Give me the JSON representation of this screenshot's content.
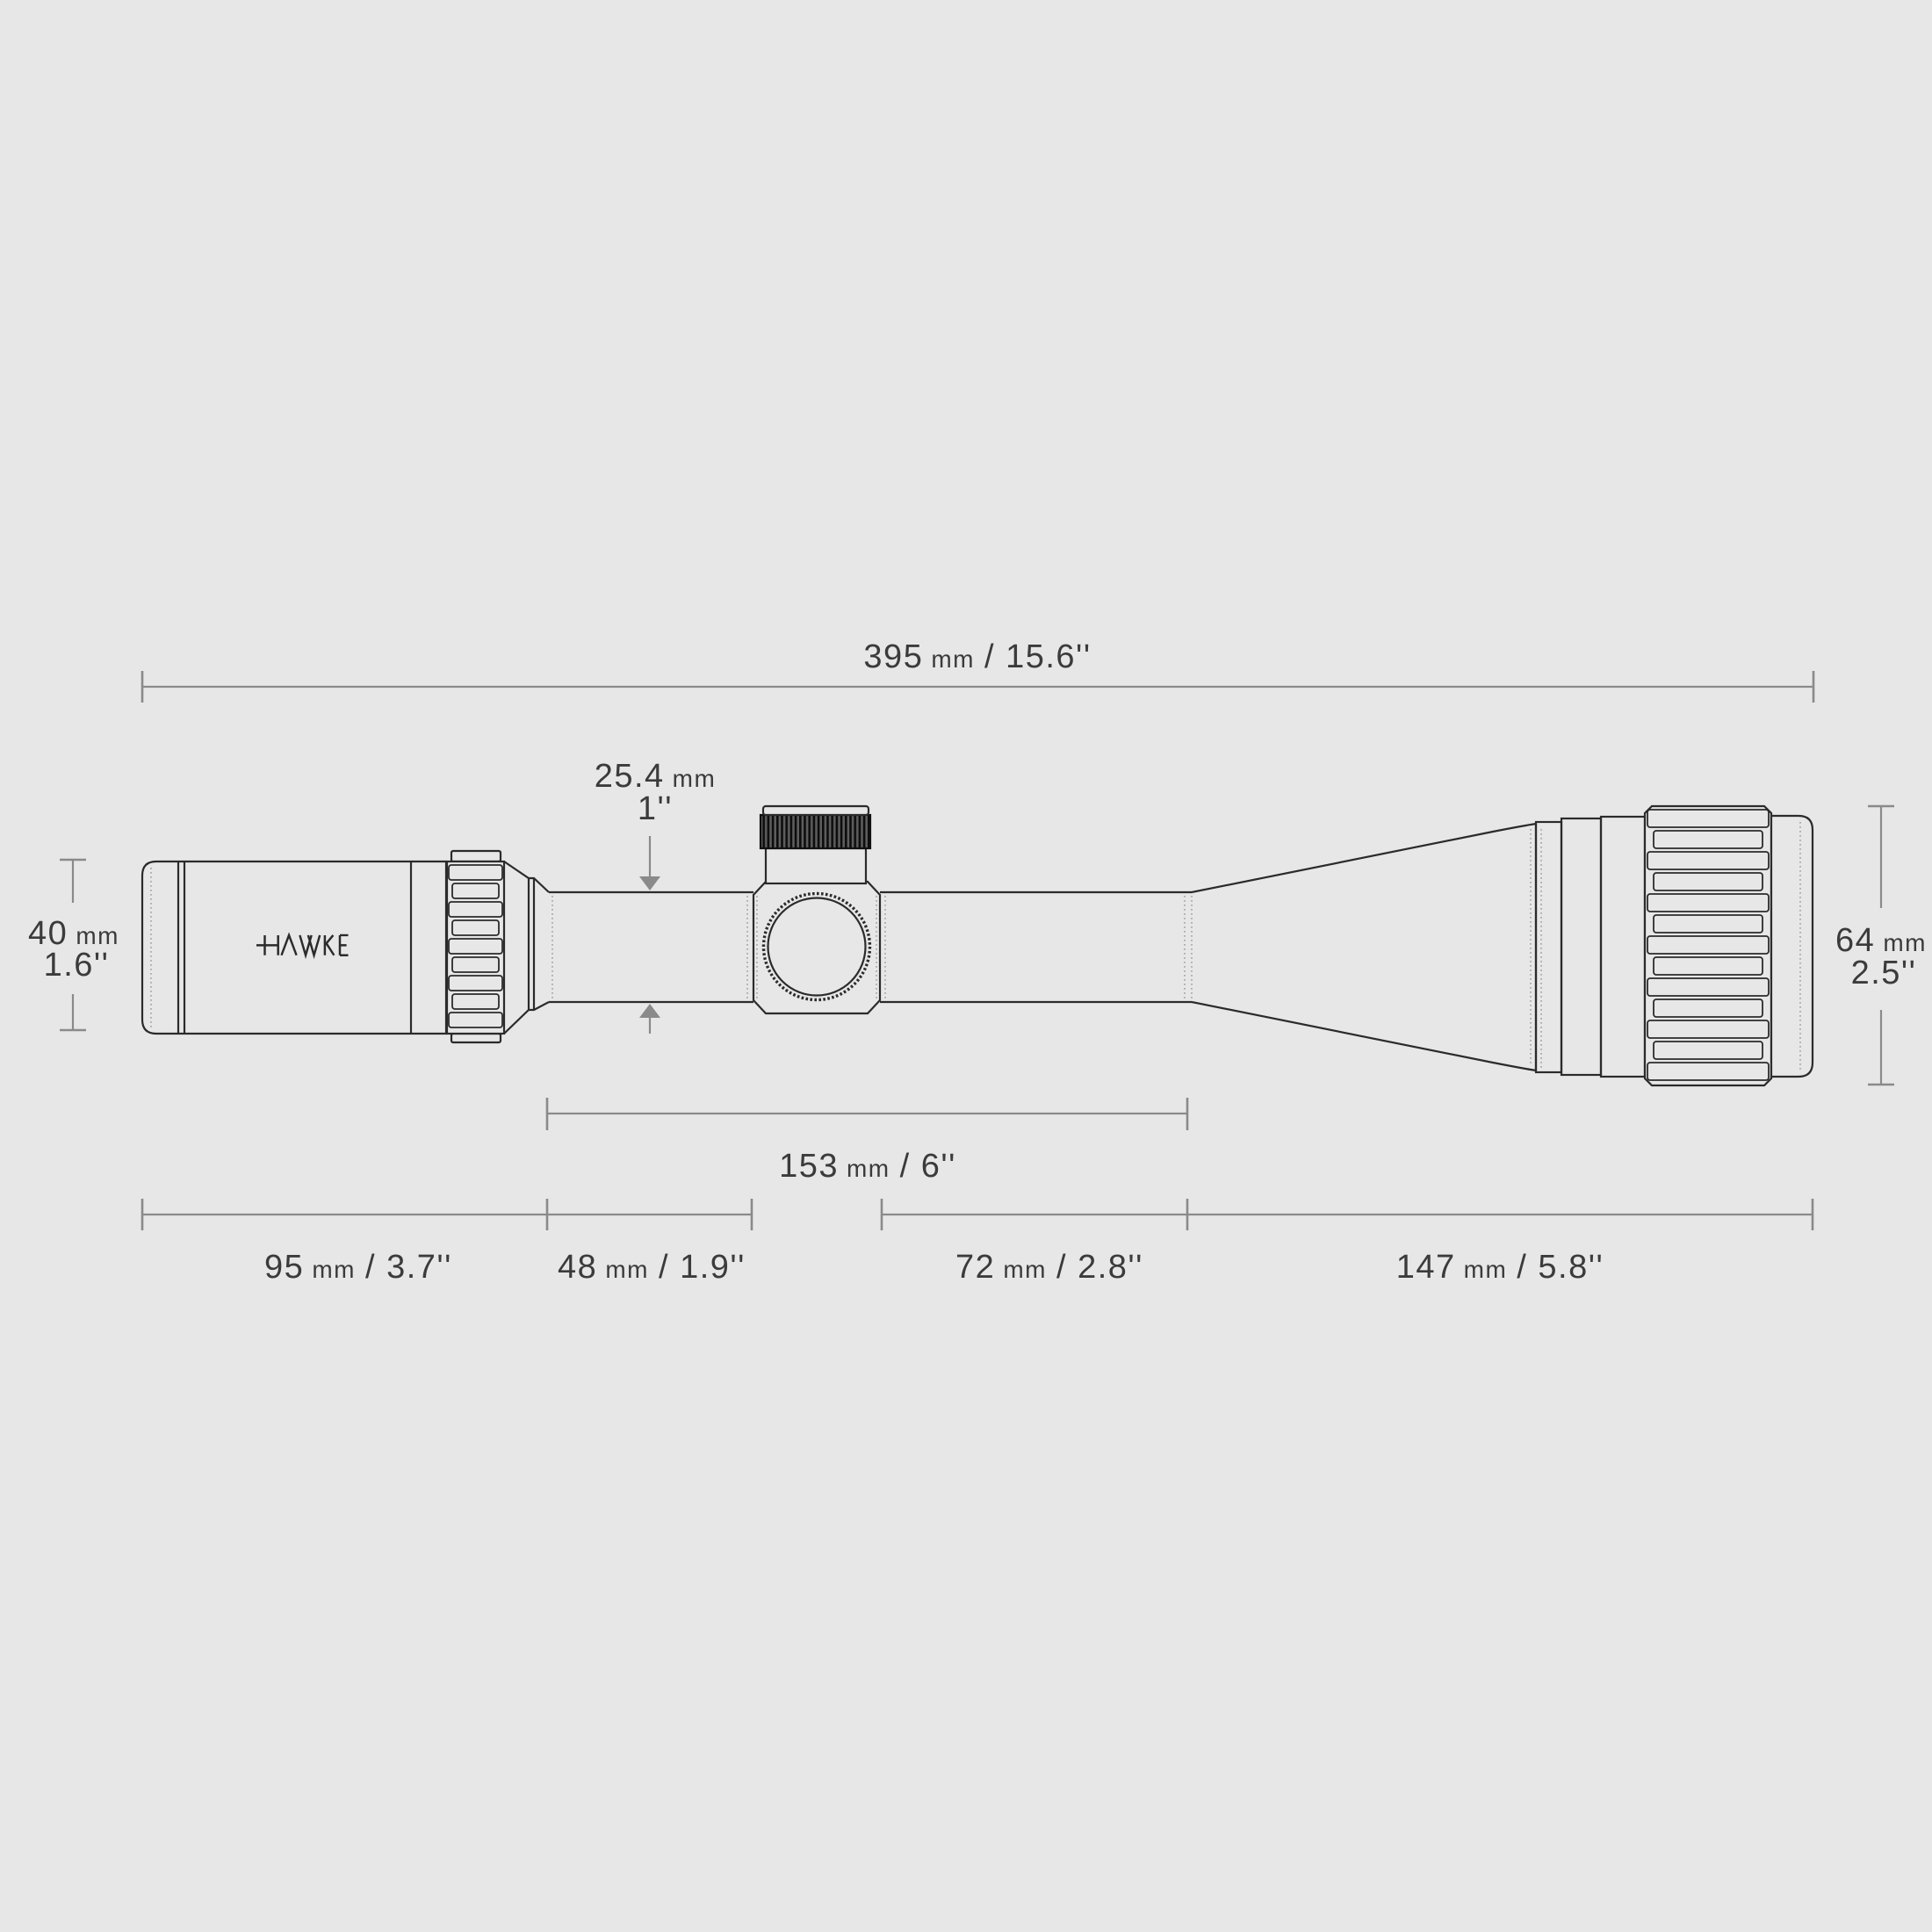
{
  "meta": {
    "description": "Technical dimension diagram of a rifle scope, side view on grey background"
  },
  "brand": "HAWKE",
  "colors": {
    "background": "#e7e7e7",
    "outline": "#2b2b2b",
    "dimension_lines": "#8a8a8a",
    "label_text": "#3b3b3b",
    "turret_knurl_dark": "#0d0d0d"
  },
  "dims": {
    "overall": {
      "value": "395",
      "unit": "mm",
      "rest": "/ 15.6''"
    },
    "tube_dia": {
      "value": "25.4",
      "unit": "mm",
      "inches": "1''"
    },
    "eyepiece_dia": {
      "value": "40",
      "unit": "mm",
      "inches": "1.6''"
    },
    "objective_dia": {
      "value": "64",
      "unit": "mm",
      "inches": "2.5''"
    },
    "mid_length": {
      "value": "153",
      "unit": "mm",
      "rest": "/ 6''"
    },
    "eyepiece_len": {
      "value": "95",
      "unit": "mm",
      "rest": "/ 3.7''"
    },
    "saddle_len": {
      "value": "48",
      "unit": "mm",
      "rest": "/ 1.9''"
    },
    "tube_len": {
      "value": "72",
      "unit": "mm",
      "rest": "/ 2.8''"
    },
    "objective_len": {
      "value": "147",
      "unit": "mm",
      "rest": "/ 5.8''"
    }
  }
}
